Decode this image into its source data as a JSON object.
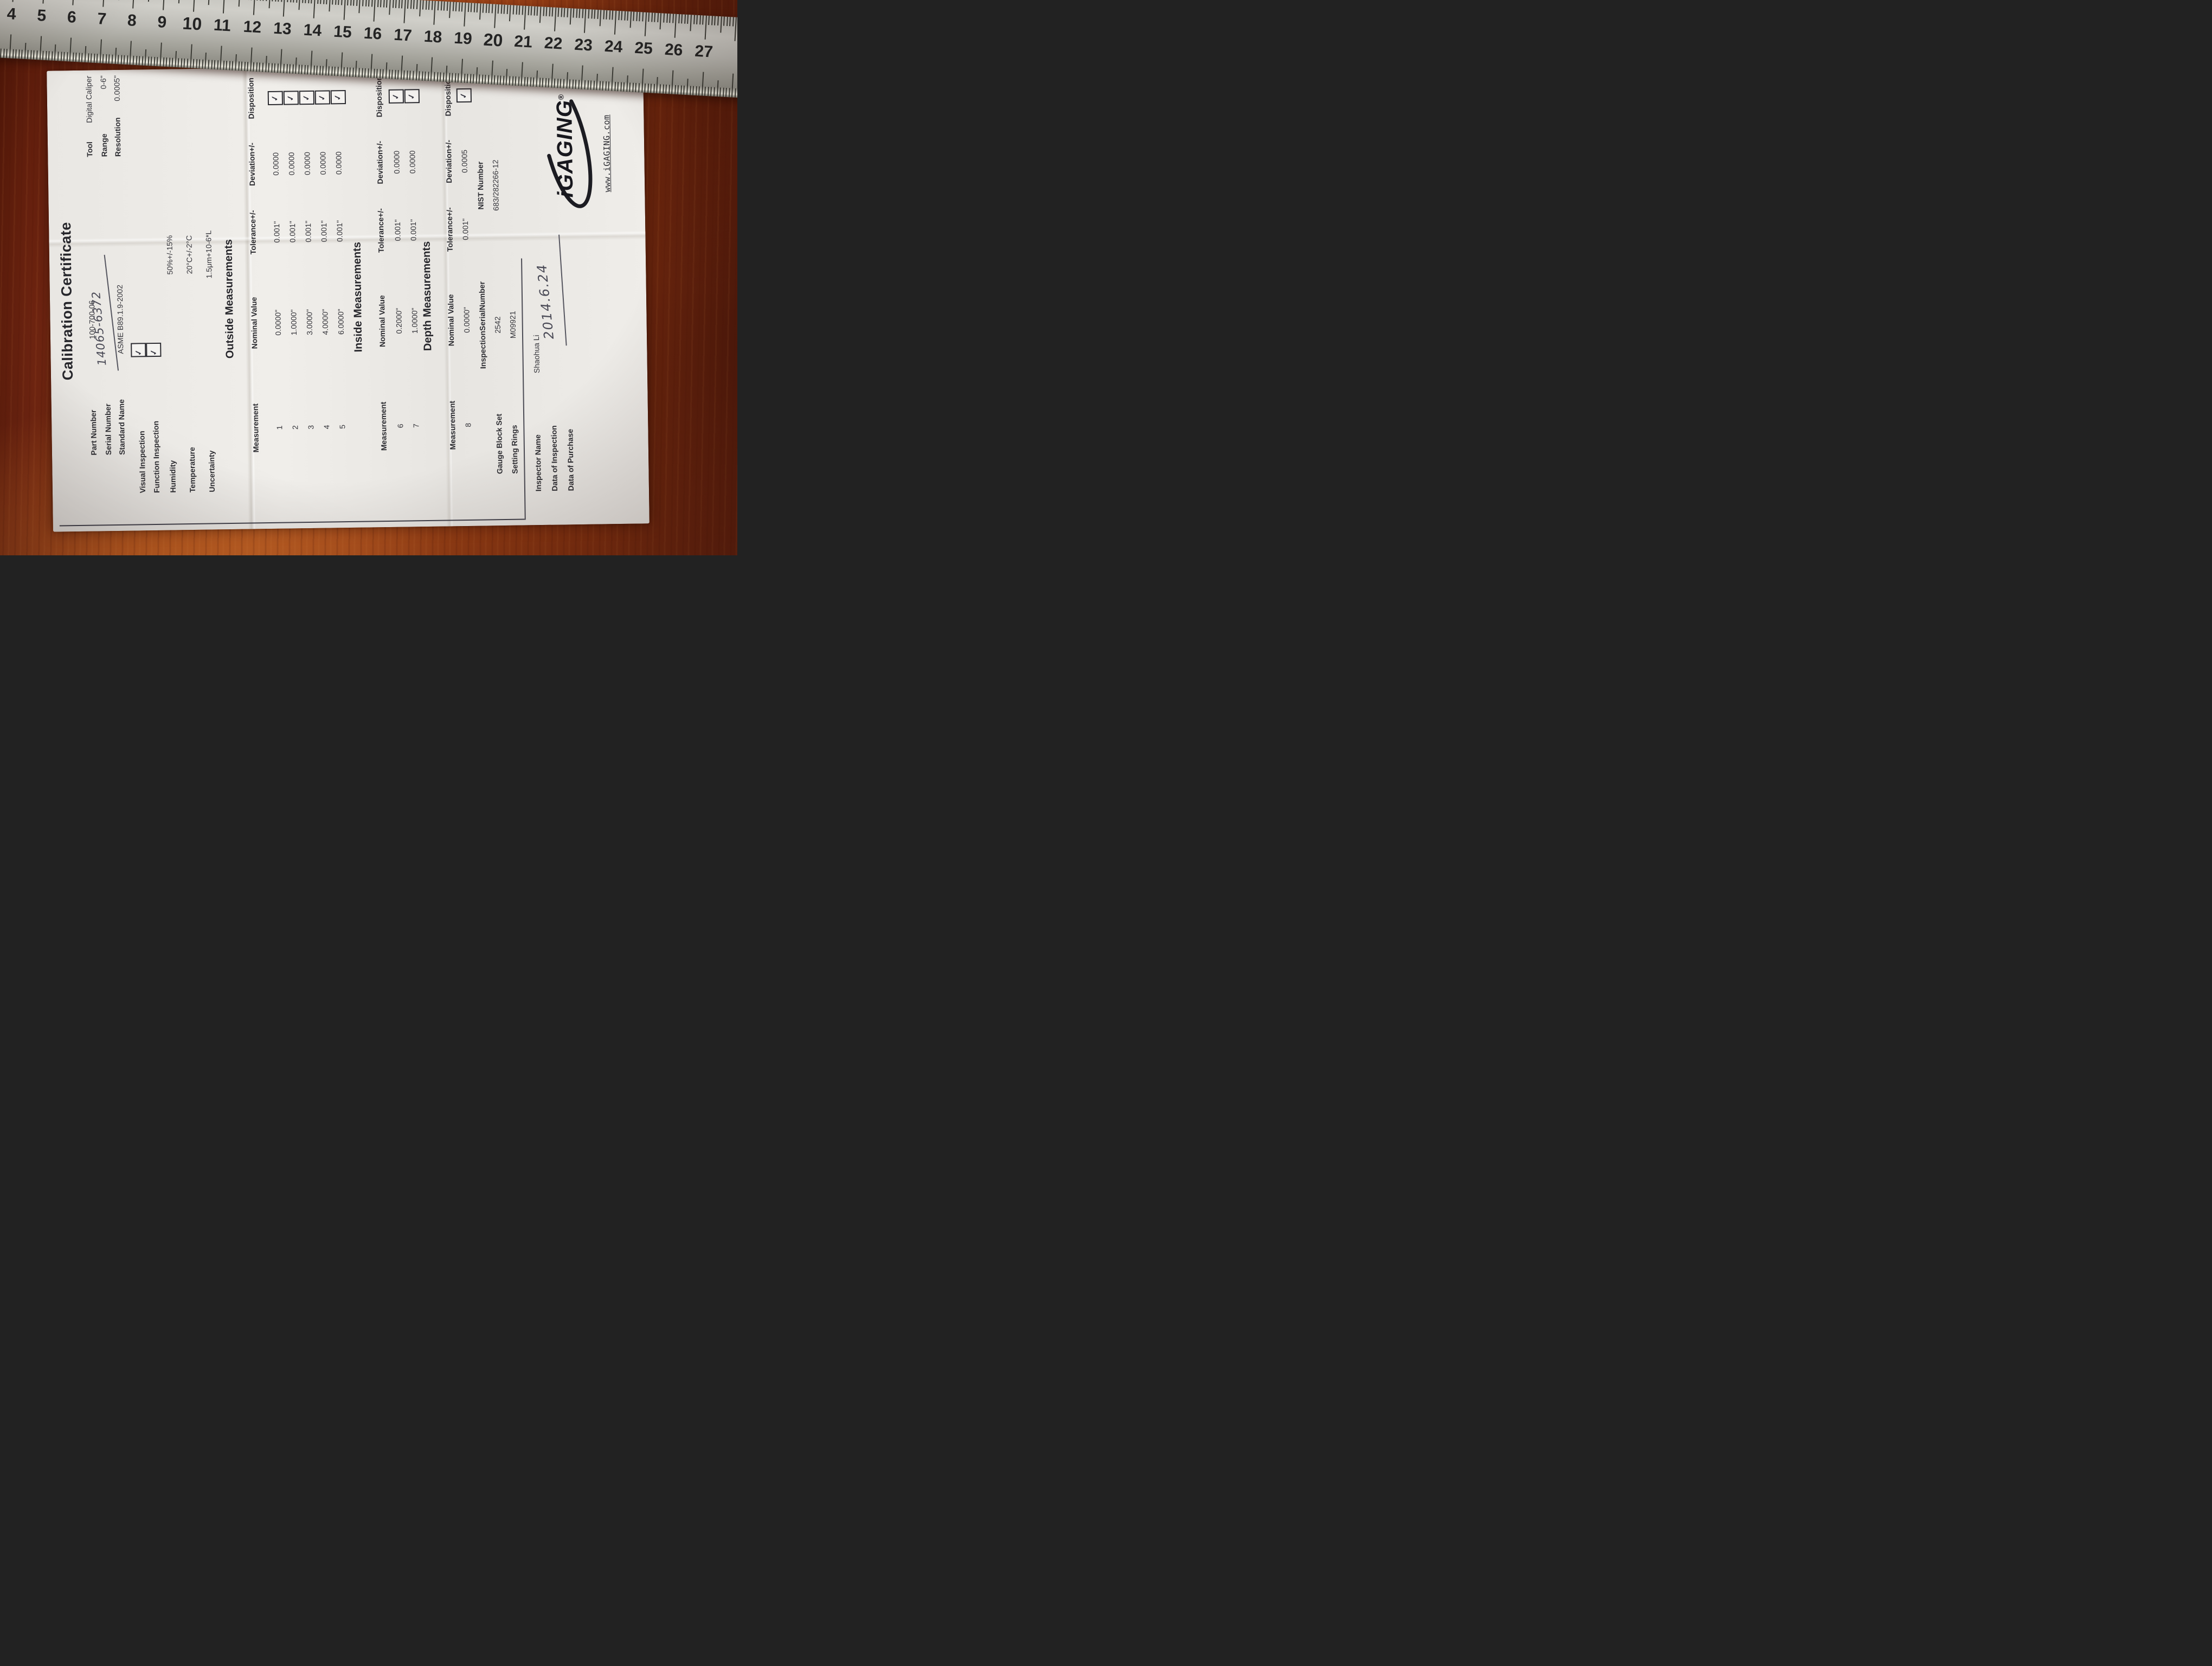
{
  "colors": {
    "wood": "#9a4016",
    "ruler_metal": "#b5b4ae",
    "paper": "#edebe7",
    "ink": "#2e2e33"
  },
  "ruler": {
    "numbers": [
      "4",
      "5",
      "6",
      "7",
      "8",
      "9",
      "10",
      "11",
      "12",
      "13",
      "14",
      "15",
      "16",
      "17",
      "18",
      "19",
      "20",
      "21",
      "22",
      "23",
      "24",
      "25",
      "26",
      "27"
    ],
    "bold_numbers": [
      10,
      20
    ]
  },
  "certificate": {
    "title": "Calibration Certificate",
    "header": {
      "part_number_label": "Part Number",
      "part_number_value": "100-700-06",
      "serial_number_label": "Serial Number",
      "serial_number_value": "14065-6372",
      "standard_name_label": "Standard Name",
      "standard_name_value": "ASME B89.1.9-2002",
      "tool_label": "Tool",
      "tool_value": "Digital Caliper",
      "range_label": "Range",
      "range_value": "0-6\"",
      "resolution_label": "Resolution",
      "resolution_value": "0.0005\""
    },
    "inspections": {
      "visual_label": "Visual Inspection",
      "function_label": "Function Inspection"
    },
    "environment": {
      "humidity_label": "Humidity",
      "humidity_value": "50%+/-15%",
      "temperature_label": "Temperature",
      "temperature_value": "20°C+/-2°C",
      "uncertainty_label": "Uncertainty",
      "uncertainty_value": "1.5μm+10-6*L"
    },
    "check_glyph": "✓",
    "table_headers": {
      "measurement": "Measurement",
      "nominal": "Nominal Value",
      "tolerance": "Tolerance+/-",
      "deviation": "Deviation+/-",
      "disposition": "Disposition"
    },
    "outside": {
      "heading": "Outside Measurements",
      "rows": [
        {
          "n": "1",
          "nominal": "0.0000\"",
          "tolerance": "0.001\"",
          "deviation": "0.0000"
        },
        {
          "n": "2",
          "nominal": "1.0000\"",
          "tolerance": "0.001\"",
          "deviation": "0.0000"
        },
        {
          "n": "3",
          "nominal": "3.0000\"",
          "tolerance": "0.001\"",
          "deviation": "0.0000"
        },
        {
          "n": "4",
          "nominal": "4.0000\"",
          "tolerance": "0.001\"",
          "deviation": "0.0000"
        },
        {
          "n": "5",
          "nominal": "6.0000\"",
          "tolerance": "0.001\"",
          "deviation": "0.0000"
        }
      ]
    },
    "inside": {
      "heading": "Inside Measurements",
      "rows": [
        {
          "n": "6",
          "nominal": "0.2000\"",
          "tolerance": "0.001\"",
          "deviation": "0.0000"
        },
        {
          "n": "7",
          "nominal": "1.0000\"",
          "tolerance": "0.001\"",
          "deviation": "0.0000"
        }
      ]
    },
    "depth": {
      "heading": "Depth Measurements",
      "rows": [
        {
          "n": "8",
          "nominal": "0.0000\"",
          "tolerance": "0.001\"",
          "deviation": "0.0005"
        }
      ]
    },
    "traceability": {
      "inspection_serial_header": "InspectionSerialNumber",
      "nist_header": "NIST Number",
      "gauge_label": "Gauge Block Set",
      "gauge_serial": "2542",
      "gauge_nist": "683/282266-12",
      "rings_label": "Setting Rings",
      "rings_serial": "M09921"
    },
    "signoff": {
      "inspector_label": "Inspector Name",
      "inspector_value": "Shaohua Li",
      "inspection_date_label": "Data of Inspection",
      "inspection_date_value": "2014.6.24",
      "purchase_date_label": "Data of Purchase"
    },
    "brand": {
      "logo_text": "iGAGING",
      "registered_mark": "®",
      "website": "www.iGAGING.com"
    }
  }
}
